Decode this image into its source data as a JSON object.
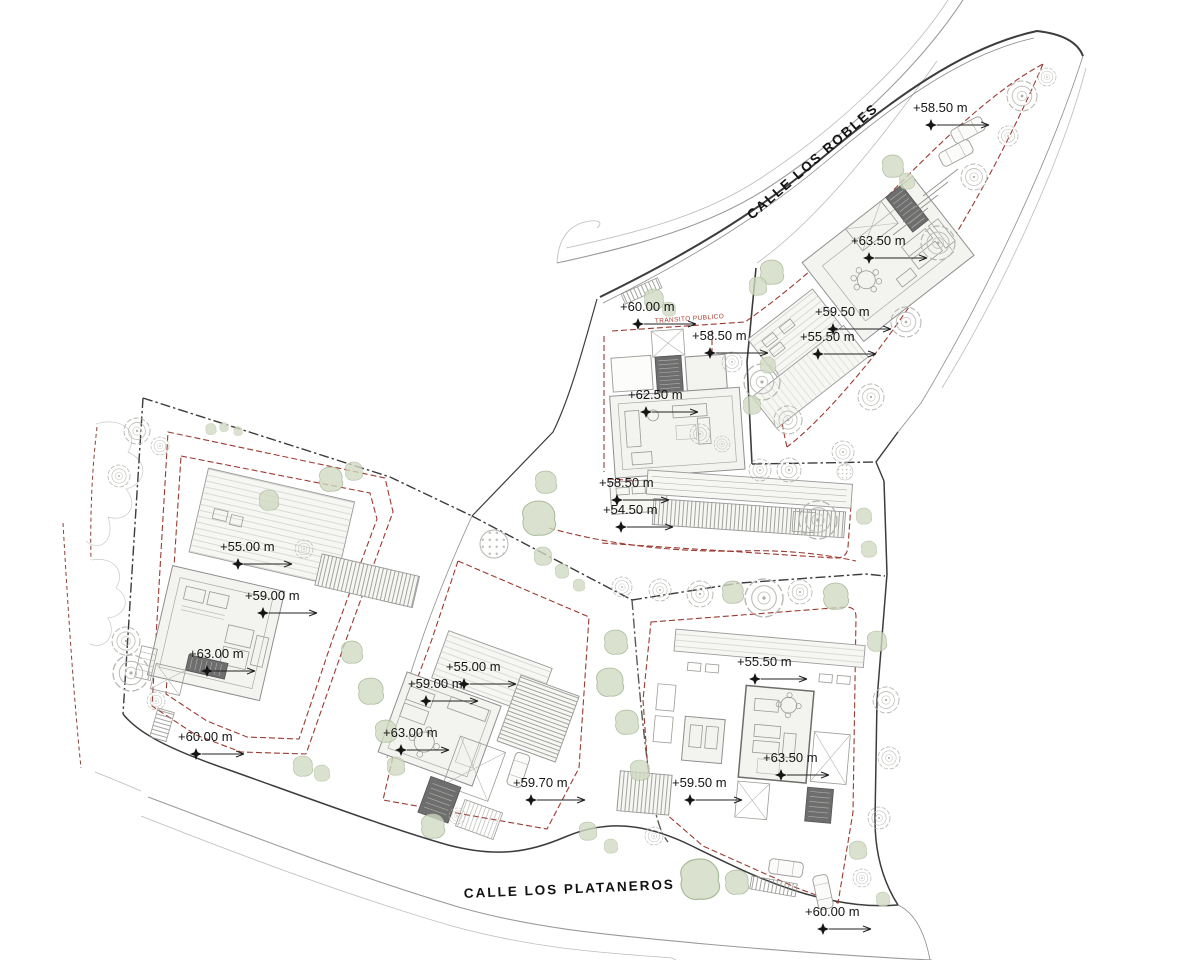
{
  "plan": {
    "streets": [
      {
        "name": "CALLE LOS ROBLES"
      },
      {
        "name": "CALLE LOS PLATANEROS"
      }
    ],
    "annotation": {
      "text": "TRANSITO PUBLICO"
    },
    "elevation_markers": [
      {
        "area": "villa-a-parking",
        "label": "+58.50 m"
      },
      {
        "area": "villa-a-roof",
        "label": "+63.50 m"
      },
      {
        "area": "villa-a-terrace",
        "label": "+59.50 m"
      },
      {
        "area": "villa-a-garden",
        "label": "+55.50 m"
      },
      {
        "area": "villa-b-street",
        "label": "+60.00 m"
      },
      {
        "area": "villa-b-entry",
        "label": "+58.50 m"
      },
      {
        "area": "villa-b-roof",
        "label": "+62.50 m"
      },
      {
        "area": "villa-b-terrace",
        "label": "+58.50 m"
      },
      {
        "area": "villa-b-garden",
        "label": "+54.50 m"
      },
      {
        "area": "villa-c-garden",
        "label": "+55.00 m"
      },
      {
        "area": "villa-c-terrace",
        "label": "+59.00 m"
      },
      {
        "area": "villa-c-roof",
        "label": "+63.00 m"
      },
      {
        "area": "villa-c-entry",
        "label": "+60.00 m"
      },
      {
        "area": "villa-d-garden",
        "label": "+55.00 m"
      },
      {
        "area": "villa-d-terrace",
        "label": "+59.00 m"
      },
      {
        "area": "villa-d-roof",
        "label": "+63.00 m"
      },
      {
        "area": "villa-d-entry",
        "label": "+59.70 m"
      },
      {
        "area": "villa-e-garden",
        "label": "+55.50 m"
      },
      {
        "area": "villa-e-roof",
        "label": "+63.50 m"
      },
      {
        "area": "villa-e-terrace",
        "label": "+59.50 m"
      },
      {
        "area": "villa-e-entry",
        "label": "+60.00 m"
      }
    ],
    "colors": {
      "background": "#ffffff",
      "setback_dashed": "#9c3a31",
      "neighbor_dashed": "#8a4038",
      "boundary": "#3c3c3c",
      "road_edge": "#9a9a96",
      "building_fill": "#f3f3f0",
      "building_stroke": "#8f8f8f",
      "tree_outline": "#b5b5b0",
      "tree_green_fill": "#cfdac2",
      "marker_text": "#141414",
      "annotation_red": "#b03a2e"
    }
  }
}
